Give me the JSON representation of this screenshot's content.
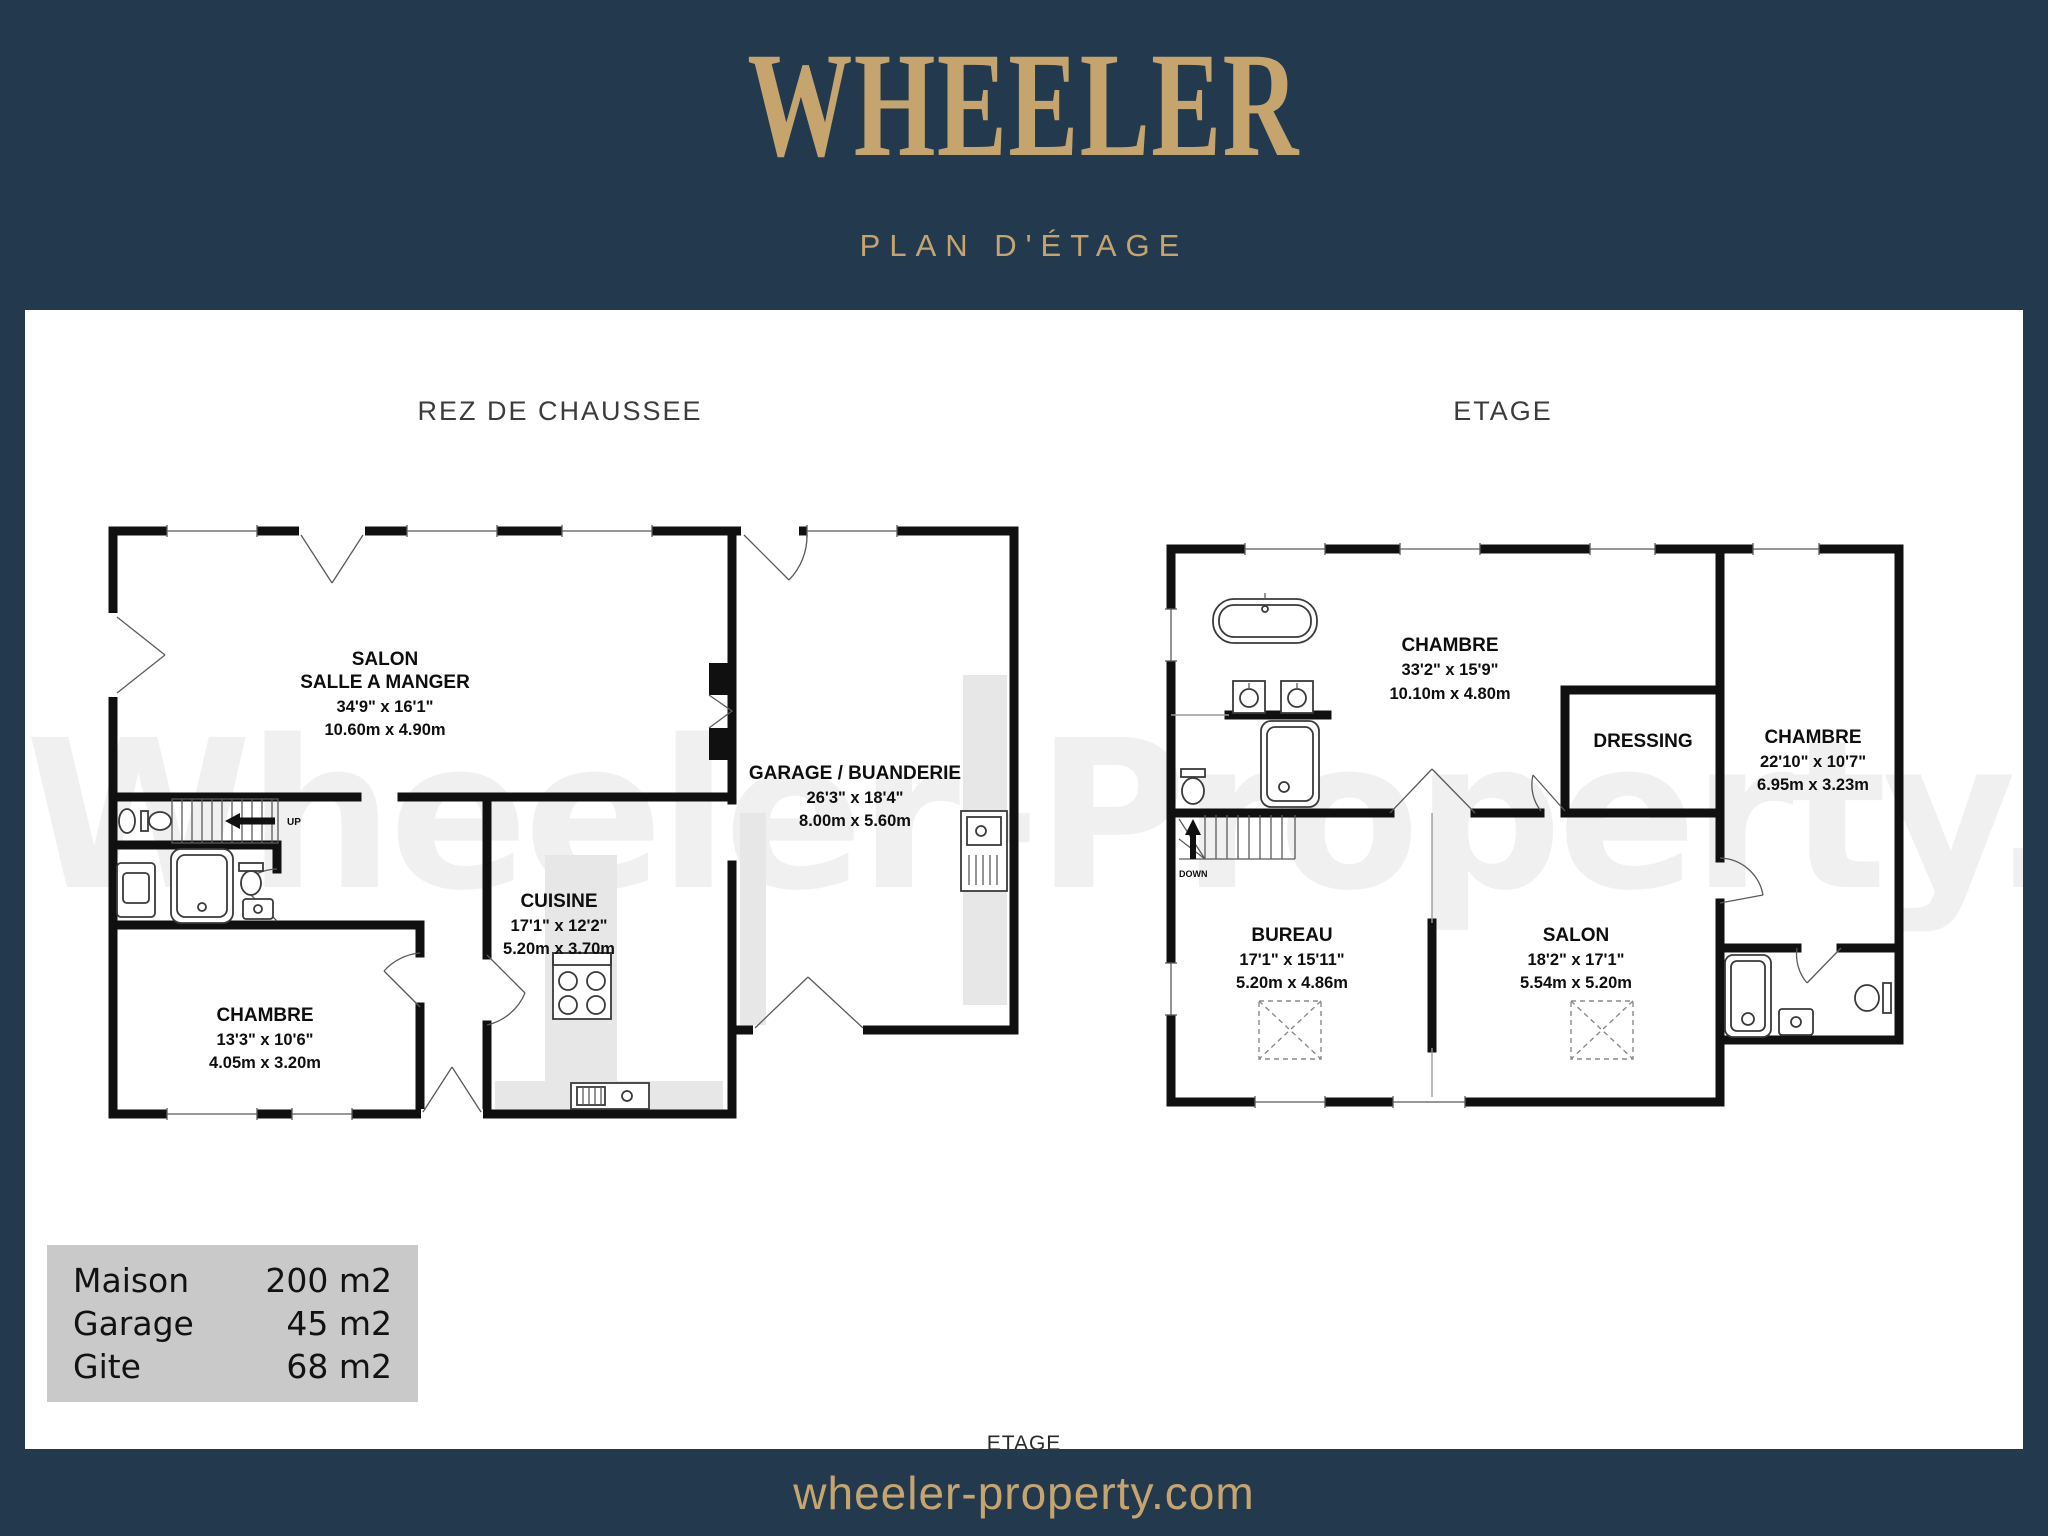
{
  "header": {
    "brand": "WHEELER",
    "subtitle": "PLAN D'ÉTAGE"
  },
  "card": {
    "watermark": "Wheeler-Property.com",
    "bottom_label": "ETAGE"
  },
  "plans": {
    "ground": {
      "title": "REZ DE CHAUSSEE",
      "stairs_label": "UP",
      "rooms": [
        {
          "name_lines": [
            "SALON",
            "SALLE A MANGER"
          ],
          "imperial": "34'9\"  x 16'1\"",
          "metric": "10.60m  x 4.90m"
        },
        {
          "name_lines": [
            "GARAGE / BUANDERIE"
          ],
          "imperial": "26'3\"  x 18'4\"",
          "metric": "8.00m  x 5.60m"
        },
        {
          "name_lines": [
            "CUISINE"
          ],
          "imperial": "17'1\"  x 12'2\"",
          "metric": "5.20m  x 3.70m"
        },
        {
          "name_lines": [
            "CHAMBRE"
          ],
          "imperial": "13'3\"  x 10'6\"",
          "metric": "4.05m  x 3.20m"
        }
      ]
    },
    "upper": {
      "title": "ETAGE",
      "stairs_label": "DOWN",
      "rooms": [
        {
          "name_lines": [
            "CHAMBRE"
          ],
          "imperial": "33'2\"  x 15'9\"",
          "metric": "10.10m  x 4.80m"
        },
        {
          "name_lines": [
            "DRESSING"
          ]
        },
        {
          "name_lines": [
            "CHAMBRE"
          ],
          "imperial": "22'10\"  x 10'7\"",
          "metric": "6.95m  x 3.23m"
        },
        {
          "name_lines": [
            "BUREAU"
          ],
          "imperial": "17'1\"  x 15'11\"",
          "metric": "5.20m  x 4.86m"
        },
        {
          "name_lines": [
            "SALON"
          ],
          "imperial": "18'2\"  x 17'1\"",
          "metric": "5.54m  x 5.20m"
        }
      ]
    }
  },
  "legend": {
    "rows": [
      {
        "label": "Maison",
        "value": "200 m2"
      },
      {
        "label": "Garage",
        "value": "45 m2"
      },
      {
        "label": "Gite",
        "value": "68 m2"
      }
    ]
  },
  "footer": {
    "url": "wheeler-property.com"
  },
  "colors": {
    "background": "#23394e",
    "accent_gold": "#c5a56d",
    "wall": "#101010",
    "shade": "#e7e7e7",
    "legend_bg": "#c9c9c9",
    "watermark": "#f0f0f0"
  }
}
